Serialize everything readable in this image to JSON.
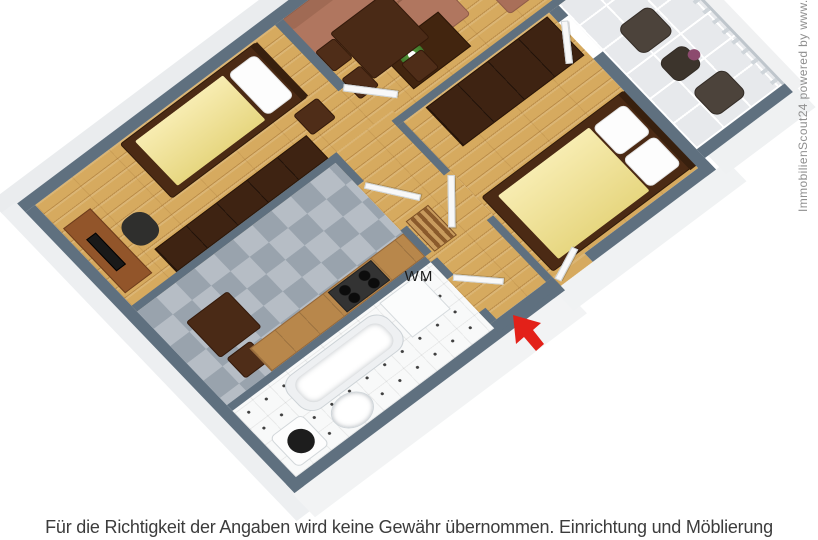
{
  "labels": {
    "washing_machine": "WM"
  },
  "caption": {
    "text": "Für die Richtigkeit der Angaben wird keine Gewähr übernommen. Einrichtung und Möblierung"
  },
  "watermark": {
    "text": "ImmobilienScout24 powered by www.di"
  },
  "palette": {
    "wall_top": "#5f707f",
    "wall_face": "#f1f2f3",
    "wood_floor": "#d6aa5f",
    "kitchen_tile_dark": "#99a3ad",
    "kitchen_tile_light": "#b6bdc5",
    "bath_tile": "#f8f9f9",
    "balcony_tile": "#e7e9ec",
    "bed_blanket_yellow": "#f3e287",
    "dark_wood_furniture": "#3e2312",
    "sofa_brown": "#b0765f",
    "entrance_arrow_red": "#e32119",
    "caption_text": "#3c3c3c",
    "watermark_text": "#8f8f8f"
  }
}
